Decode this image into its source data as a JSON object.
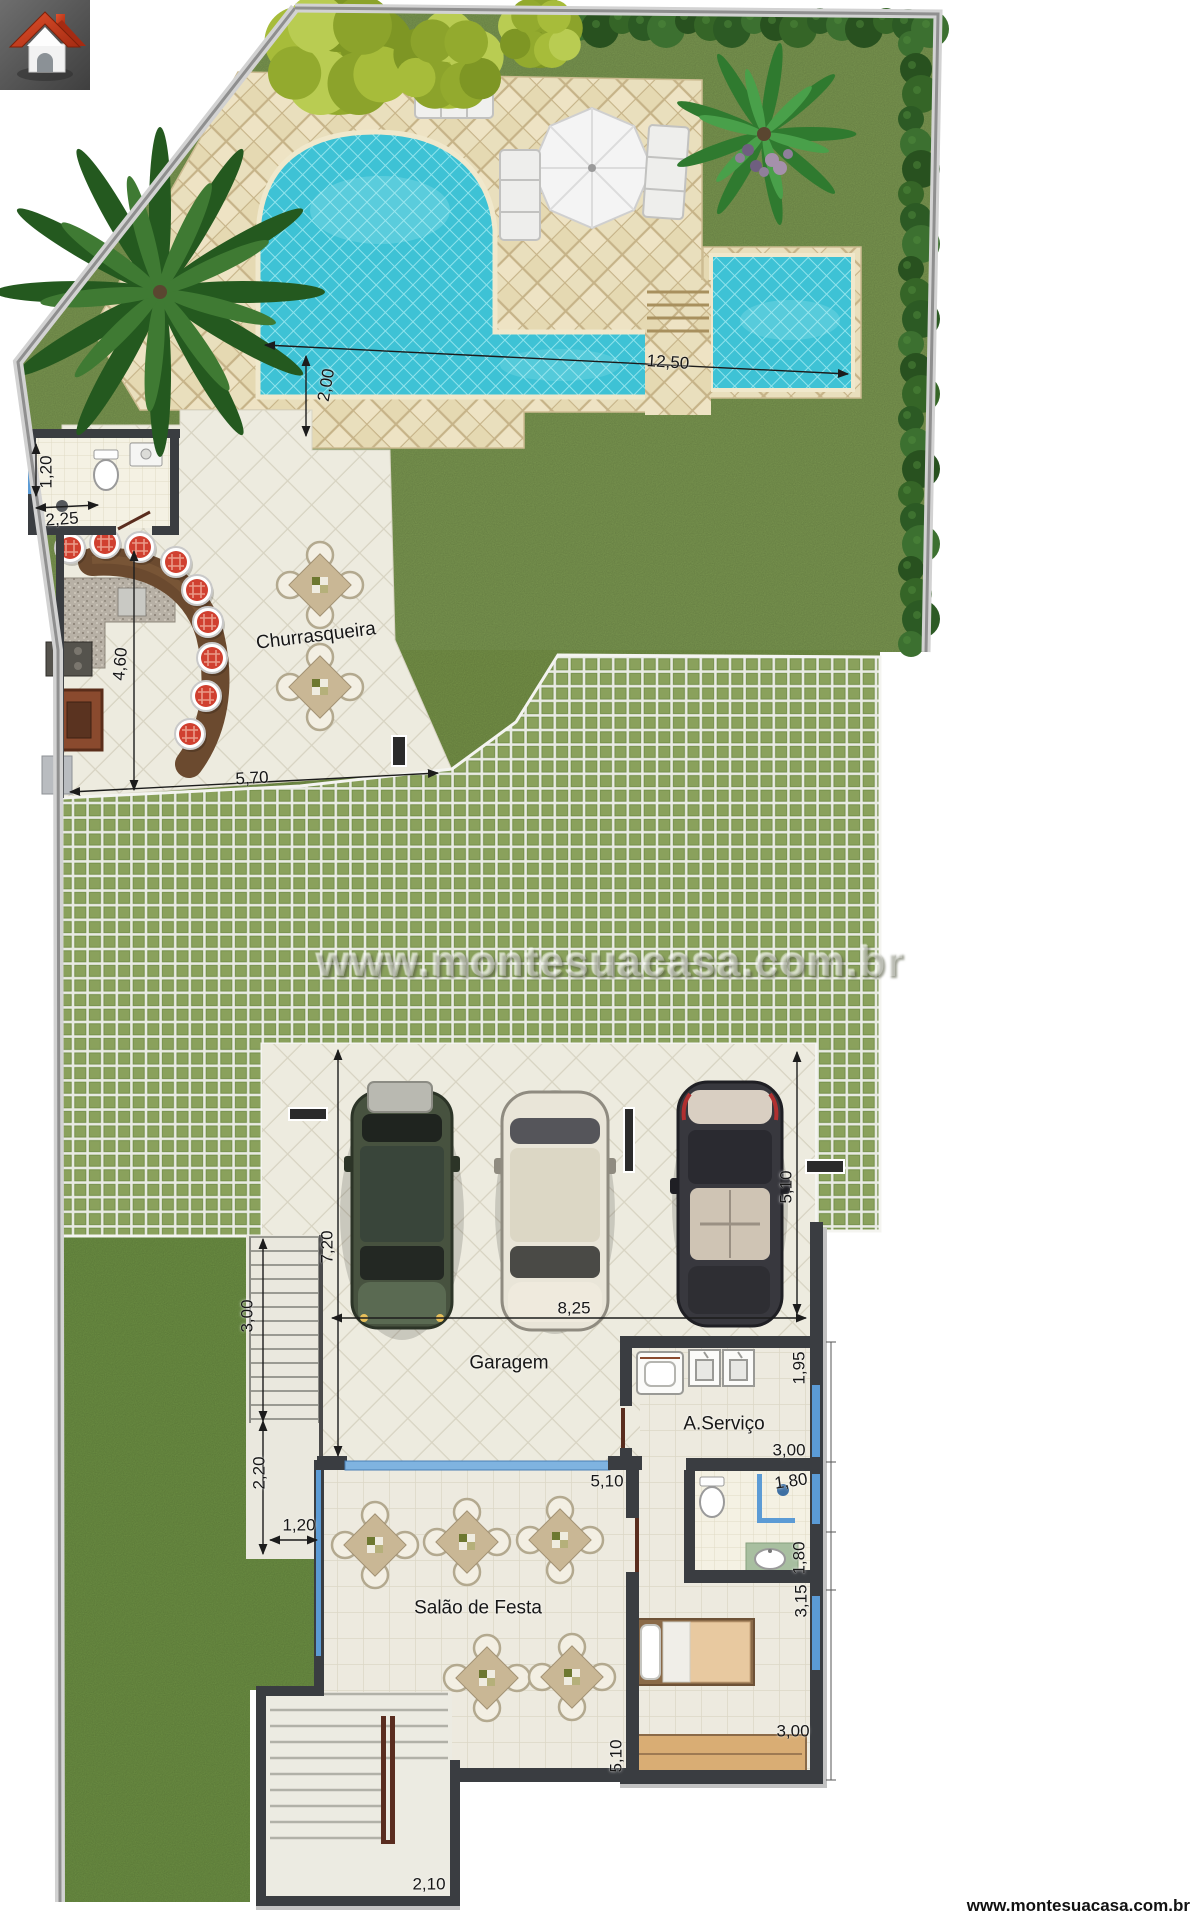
{
  "watermarks": {
    "center": "www.montesuacasa.com.br",
    "footer": "www.montesuacasa.com.br"
  },
  "rooms": {
    "churrasqueira": "Churrasqueira",
    "garagem": "Garagem",
    "a_servico": "A.Serviço",
    "salao_de_festa": "Salão de Festa"
  },
  "dimensions": {
    "pool_width": "2,00",
    "pool_length": "12,50",
    "wc_width": "1,20",
    "wc_length": "2,25",
    "churrasqueira_depth": "4,60",
    "churrasqueira_width": "5,70",
    "garage_depth": "7,20",
    "garage_width": "8,25",
    "garage_right_depth": "5,10",
    "entry_stairs_run": "3,00",
    "porch_depth": "2,20",
    "porch_width": "1,20",
    "salao_width": "5,10",
    "salao_depth": "5,10",
    "servico_depth": "1,95",
    "servico_width": "3,00",
    "bathroom_width": "1,80",
    "bathroom_depth": "1,80",
    "suite_strip_depth": "3,15",
    "bedroom_width": "3,00",
    "lower_stairs_width": "2,10"
  },
  "colors": {
    "grass": "#7d9a52",
    "pool_water": "#3ec2d5",
    "paver_green": "#8aa15c",
    "terrace_stone": "#e9dfbd",
    "wall": "#3a3d41",
    "glass_window": "#5b9bd5",
    "stool_red": "#d04030",
    "logo_red": "#c8361b"
  }
}
